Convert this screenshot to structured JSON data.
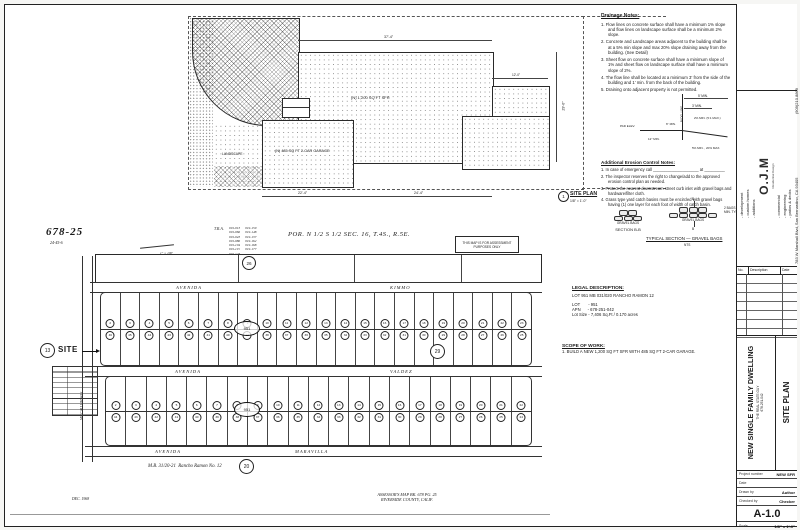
{
  "site_plan": {
    "title": "SITE PLAN",
    "title_num": "1",
    "scale": "1/8\" = 1'-0\"",
    "labels": {
      "sfr": "(N) 1,200 SQ FT SFR",
      "garage": "(N) 485 SQ FT 2-CAR GARAGE",
      "landscape": "LANDSCAPE"
    },
    "dims": {
      "top": "37'-4\"",
      "right": "29'-0\"",
      "bottom_left": "22'-4\"",
      "bottom_right": "24'-4\"",
      "adj_top": "12'-0\""
    }
  },
  "drainage": {
    "title": "Drainage Notes:",
    "items": [
      "1.  Flow lines on concrete surface shall have a minimum 1% slope and flow lines on landscape surface shall be a minimum 2% slope.",
      "2.  Concrete and Landscape areas adjacent to the building shall be at a 5% min slope and max 20% slope draining away from the building. (See Detail)",
      "3.  Sheet flow on concrete surface shall have a minimum slope of 1% and sheet flow on landscape surface shall have a minimum slope of 2%.",
      "4.  The flow line shall be located at a minimum 3' from the side of the building and 1' min. from the back of the building.",
      "5.  Draining onto adjacent property is not permitted."
    ]
  },
  "detail": {
    "dim_5min": "5' MIN.",
    "dim_3min": "3' MIN.",
    "bldg_line": "BLDG. LINE",
    "slope1": "2% MIN. (5:1 MAX.)",
    "pad": "PAD ELEV.",
    "dim_6": "6\" MIN.",
    "dim_12": "12\" MIN.",
    "slope2": "5% MIN. , 20% MAX."
  },
  "erosion": {
    "title": "Additional Erosion Control Notes:",
    "items": [
      "1.  In case of emergency call ____________________ at _________",
      "2.  The inspector reserves the right to change/add to the approved erosion control plan as needed.",
      "3.  Protect the nearest downstream street curb inlet with gravel bags and hardware/filter cloth.",
      "4.  Grass type yard catch basins must be encircled with gravel bags having (1) one layer for each foot of width of catch basin."
    ]
  },
  "section": {
    "label_b": "SECTION B-B",
    "label_typ": "TYPICAL SECTION — GRAVEL BAGS",
    "nts": "NTS",
    "bag_label1": "GRAVEL BAGS",
    "bag_label2": "GRAVEL BAGS",
    "marker": "B",
    "right_labels": [
      "2 BAGS",
      "MIN. TYP."
    ]
  },
  "legal": {
    "title": "LEGAL DESCRIPTION:",
    "line1": "LOT 951 MB 031/020 RANCHO RAMON 12",
    "lot": "LOT       - 951",
    "apn": "APN      - 678-251-042",
    "size": "Lot Size - 7,406 Sq.Ft / 0.170 acres"
  },
  "scope": {
    "title": "SCOPE OF WORK:",
    "line1": "1. BUILD A NEW 1,200 SQ FT SFR WITH 485 SQ FT 2-CAR GARAGE."
  },
  "assessor_map": {
    "page_id": "678-25",
    "page_sub": "24-45-6",
    "scale_note": "1\" = 100'",
    "tra_label": "T.R.A.",
    "tra_col1": [
      "019-013",
      "019-066",
      "019-043",
      "019-086",
      "019-104",
      "019-115",
      "019-123",
      "019-134"
    ],
    "tra_col2": [
      "019-159",
      "019-148",
      "019-137",
      "019-162",
      "019-168",
      "019-177"
    ],
    "por_title": "POR. N 1/2 S 1/2 SEC. 16, T.4S., R.5E.",
    "note_box": "THIS MAP IS FOR ASSESSMENT PURPOSES ONLY",
    "streets": {
      "kimmo_a": "AVENIDA",
      "kimmo_b": "KIMMO",
      "valdez_a": "AVENIDA",
      "valdez_b": "VALDEZ",
      "maravilla_a": "AVENIDA",
      "maravilla_b": "MARAVILLA",
      "vertical": "MC CALLUM WAY"
    },
    "refs": {
      "c13": "13",
      "c26": "26",
      "c29": "29",
      "c20": "20"
    },
    "site_label": "SITE",
    "oval_label": "951",
    "blocks": [
      {
        "top": "2 3 4 5 6 7 8 9 10 11 12 13 14 15 16 17 18 19 20 21 22 23",
        "bottom": "46 45 44 43 42 41 40 39 38 37 36 35 34 33 32 31 30 29 28 27 26 25"
      },
      {
        "top": "2 3 4 5 6 7 8 9 10 11 12 13 14 15 16 17 18 19 20 21 22",
        "bottom": "44 43 42 41 40 39 38 37 36 35 34 33 32 31 30 29 28 27 26 25 24"
      }
    ],
    "mb_note": "M.B. 31/20-21  Rancho Ramon No. 12",
    "date_note": "DEC. 1968",
    "credit1": "ASSESSOR'S MAP BK. 678 PG. 25",
    "credit2": "RIVERSIDE COUNTY, CALIF."
  },
  "titleblock": {
    "firm": {
      "services_left": [
        "- development",
        "- custom homes",
        "- additions"
      ],
      "logo": "O.J.M",
      "logo_sub": "Residential Design",
      "services_right": [
        "- commercial",
        "- engineering",
        "- patios & decks"
      ],
      "address": "783 W Marshall Blvd, San Bernardino, CA 93405",
      "phone": "(909)210.8869"
    },
    "rev_headers": [
      "No.",
      "Description",
      "Date"
    ],
    "project_title": "NEW SINGLE FAMILY DWELLING",
    "project_sub1": "THE REAL STATE GUY",
    "project_sub2": "678-251-042",
    "sheet_name": "SITE PLAN",
    "fields": [
      {
        "label": "Project number",
        "value": "NEW SFR"
      },
      {
        "label": "Date",
        "value": ""
      },
      {
        "label": "Drawn by",
        "value": "Author"
      },
      {
        "label": "Checked by",
        "value": "Checker"
      }
    ],
    "sheet_number": "A-1.0",
    "scale_label": "Scale",
    "scale_value": "1/8\" = 1'-0\""
  }
}
